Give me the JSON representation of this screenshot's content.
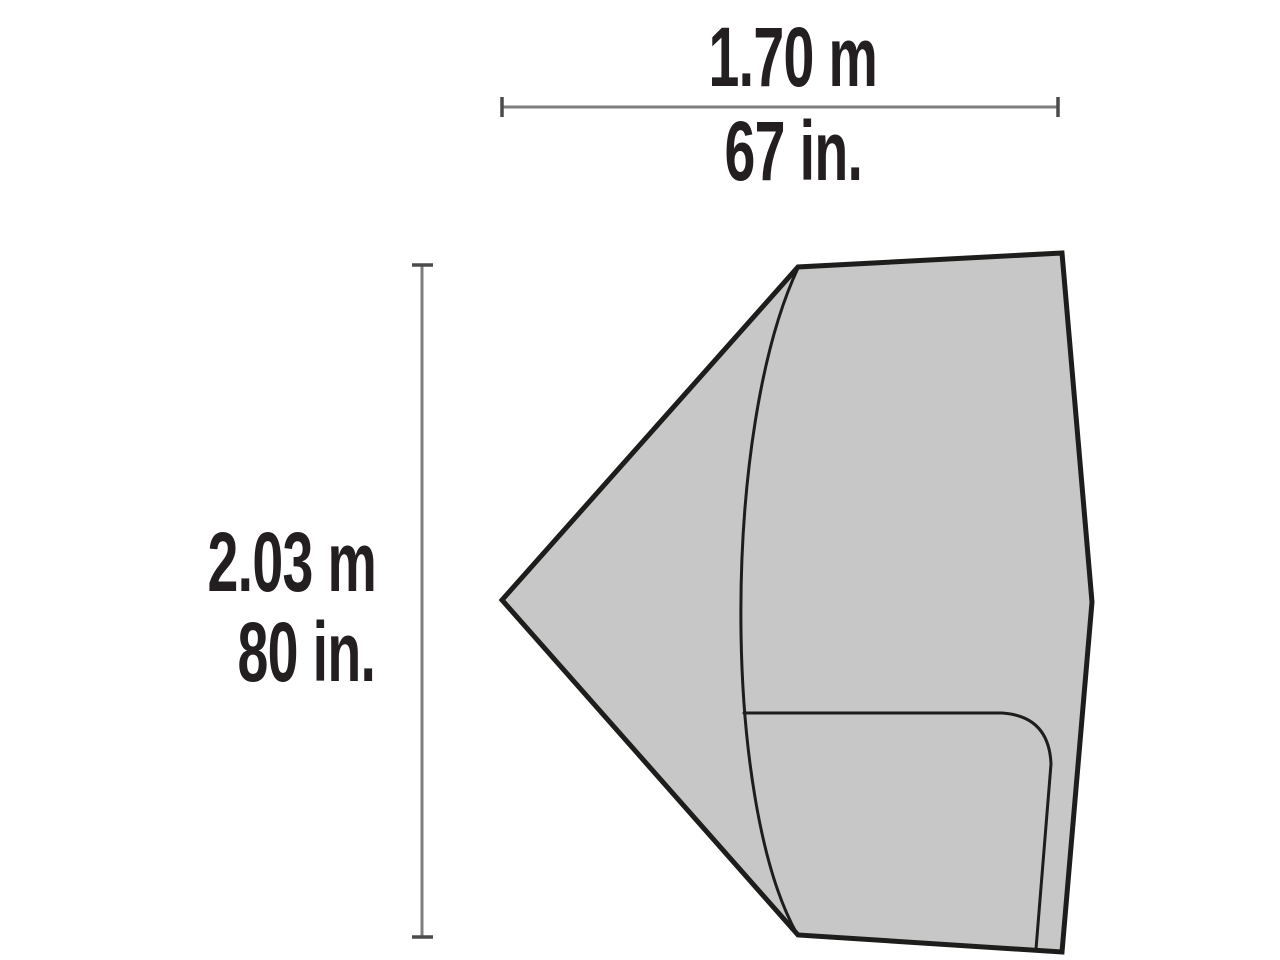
{
  "diagram": {
    "figure": "tent-footprint-plan-view",
    "labels": {
      "width_metric": "1.70 m",
      "width_imperial": "67 in.",
      "height_metric": "2.03 m",
      "height_imperial": "80 in."
    },
    "dimensions": {
      "width_m": 1.7,
      "width_in": 67,
      "height_m": 2.03,
      "height_in": 80
    },
    "colors": {
      "background": "#ffffff",
      "footprint_fill": "#c7c7c7",
      "outline": "#1d1d1b",
      "dimension_line": "#7e7e7e",
      "dimension_tick": "#4b4b4b",
      "text": "#231f20"
    }
  }
}
